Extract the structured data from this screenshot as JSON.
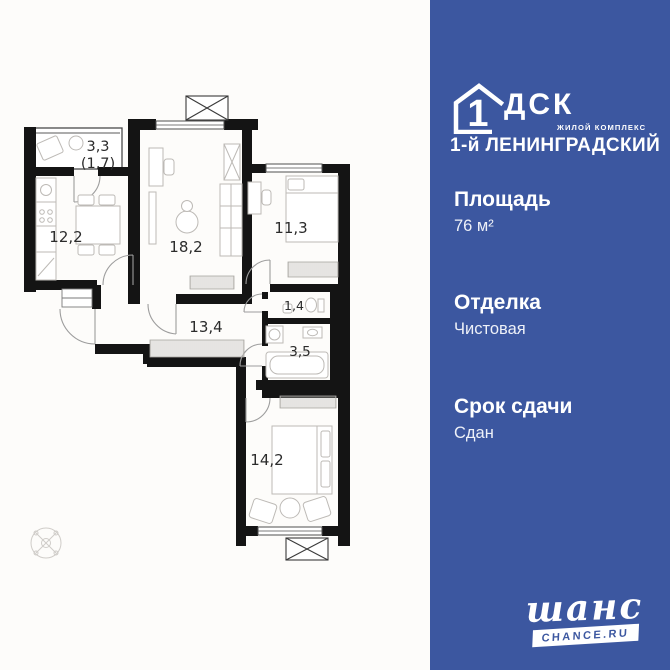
{
  "floorplan": {
    "balcony_area": "3,3",
    "balcony_area_reduced": "(1,7)",
    "kitchen_area": "12,2",
    "living_area": "18,2",
    "bedroom1_area": "11,3",
    "wc_area": "1,4",
    "hall_area": "13,4",
    "bathroom_area": "3,5",
    "bedroom2_area": "14,2",
    "colors": {
      "walls": "#141414",
      "furniture": "#bdbab6",
      "labels": "#2b2b2b"
    }
  },
  "info_panel": {
    "logo": {
      "house_number": "1",
      "brand": "ДСК",
      "tagline": "ЖИЛОЙ КОМПЛЕКС",
      "complex_name": "1-й ЛЕНИНГРАДСКИЙ"
    },
    "specs": [
      {
        "label": "Площадь",
        "value": "76 м²"
      },
      {
        "label": "Отделка",
        "value": "Чистовая"
      },
      {
        "label": "Срок сдачи",
        "value": "Сдан"
      }
    ],
    "footer": {
      "brand_script": "шанс",
      "brand_url": "CHANCE.RU"
    },
    "colors": {
      "background": "#3c57a0",
      "text": "#ffffff"
    }
  }
}
